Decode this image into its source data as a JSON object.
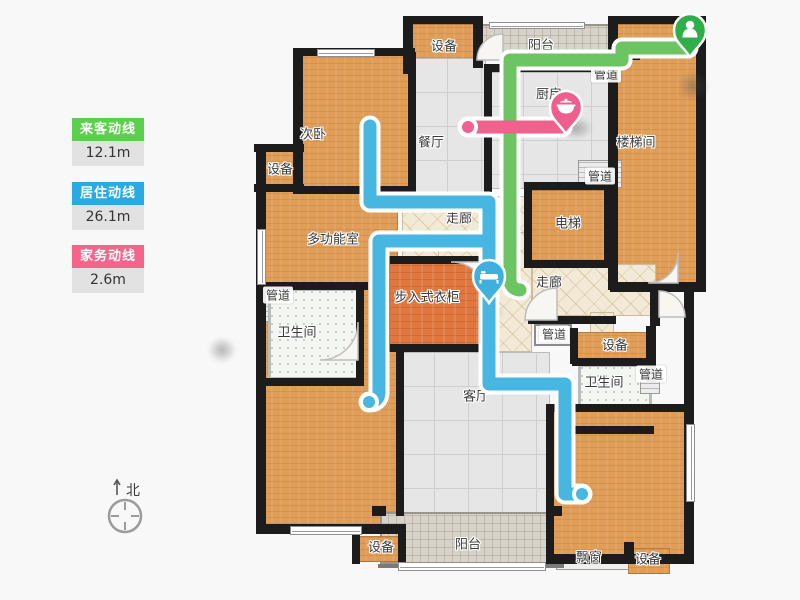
{
  "legend": {
    "items": [
      {
        "label": "来客动线",
        "value": "12.1m",
        "color": "#5ccf4e"
      },
      {
        "label": "居住动线",
        "value": "26.1m",
        "color": "#29aae1"
      },
      {
        "label": "家务动线",
        "value": "2.6m",
        "color": "#f4658c"
      }
    ]
  },
  "compass": {
    "north_label": "北"
  },
  "plan": {
    "line_colors": {
      "guest": "#6cc462",
      "living": "#47b6e1",
      "chore": "#f0618e"
    },
    "pin_colors": {
      "guest": "#2fae4a",
      "living": "#3fb0de",
      "chore": "#ee5f8d"
    },
    "markers": [
      {
        "id": "guest-start",
        "icon": "person-icon",
        "line": "guest"
      },
      {
        "id": "chore-end",
        "icon": "cookware-icon",
        "line": "chore"
      },
      {
        "id": "living-stop",
        "icon": "bed-icon",
        "line": "living"
      }
    ],
    "rooms": [
      {
        "id": "equip-top",
        "label": "设备"
      },
      {
        "id": "balcony-top",
        "label": "阳台"
      },
      {
        "id": "pipe-top",
        "label": "管道"
      },
      {
        "id": "stairwell",
        "label": "楼梯间"
      },
      {
        "id": "bedroom-second",
        "label": "次卧"
      },
      {
        "id": "dining",
        "label": "餐厅"
      },
      {
        "id": "kitchen",
        "label": "厨房"
      },
      {
        "id": "equip-left",
        "label": "设备"
      },
      {
        "id": "multi-room",
        "label": "多功能室"
      },
      {
        "id": "corridor-mid",
        "label": "走廊"
      },
      {
        "id": "elevator",
        "label": "电梯"
      },
      {
        "id": "pipe-kitchen",
        "label": "管道"
      },
      {
        "id": "foyer",
        "label": "玄关"
      },
      {
        "id": "corridor-right",
        "label": "走廊"
      },
      {
        "id": "pipe-left",
        "label": "管道"
      },
      {
        "id": "bath-left",
        "label": "卫生间"
      },
      {
        "id": "walkin-closet",
        "label": "步入式衣柜"
      },
      {
        "id": "pipe-mid",
        "label": "管道"
      },
      {
        "id": "equip-mid",
        "label": "设备"
      },
      {
        "id": "bath-right",
        "label": "卫生间"
      },
      {
        "id": "pipe-right",
        "label": "管道"
      },
      {
        "id": "living-room",
        "label": "客厅"
      },
      {
        "id": "balcony-bottom",
        "label": "阳台"
      },
      {
        "id": "equip-bottom-left",
        "label": "设备"
      },
      {
        "id": "bay-window",
        "label": "飘窗"
      },
      {
        "id": "equip-bottom-right",
        "label": "设备"
      }
    ]
  }
}
